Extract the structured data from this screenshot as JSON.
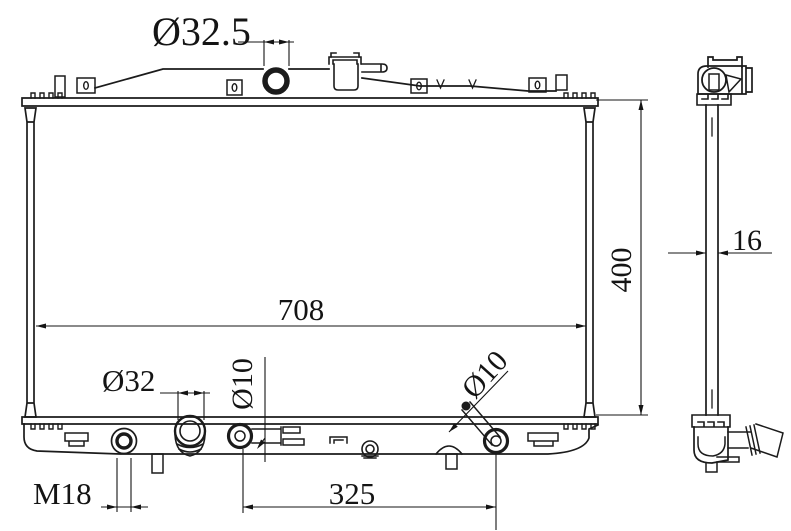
{
  "canvas": {
    "background": "#ffffff",
    "line_color": "#1b1b1b"
  },
  "dimensions": {
    "filler_neck_diameter": "Ø32.5",
    "core_width": "708",
    "overall_height": "400",
    "core_thickness": "16",
    "outlet_diameter": "Ø32",
    "left_pin_diameter": "Ø10",
    "right_pin_diameter": "Ø10",
    "drain_plug_thread": "M18",
    "pin_spacing": "325"
  }
}
